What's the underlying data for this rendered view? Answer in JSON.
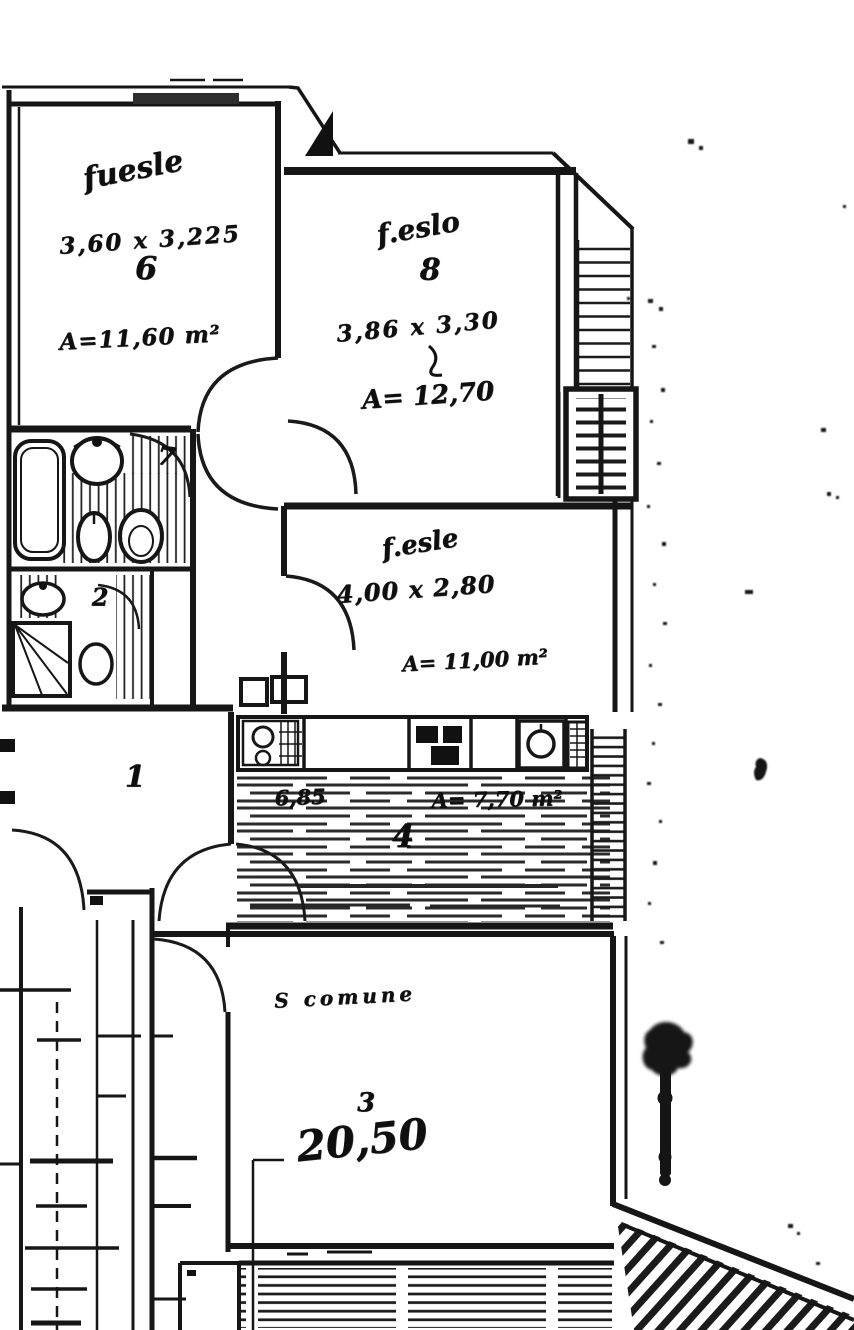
{
  "document_type": "scanned cadastral floor plan (planimetria)",
  "colors": {
    "ink": "#161616",
    "paper": "#ffffff"
  },
  "rooms": {
    "bedroom_left": {
      "label": "fuesle",
      "dimensions": "3,60 x 3,225",
      "number": "6",
      "area": "A=11,60 m²"
    },
    "bedroom_top": {
      "label": "f.eslo",
      "number": "8",
      "dimensions": "3,86 x 3,30",
      "area": "A= 12,70"
    },
    "bedroom_mid": {
      "label": "f.esle",
      "dimensions": "4,00 x 2,80",
      "area": "A= 11,00 m²"
    },
    "kitchen": {
      "dimension": "6,85",
      "area": "A= 7,70 m²",
      "number": "4"
    },
    "living": {
      "label": "S comune",
      "number": "3",
      "area": "20,50"
    },
    "hall": {
      "number": "1"
    },
    "bathroom": {
      "number": "7"
    },
    "shower_room": {
      "number": "2"
    }
  },
  "fixtures": [
    "bathtub",
    "washbasin",
    "bidet",
    "toilet",
    "shower",
    "washbasin-2",
    "toilet-2",
    "kitchen-sink",
    "stove",
    "washing-machine",
    "radiator"
  ]
}
